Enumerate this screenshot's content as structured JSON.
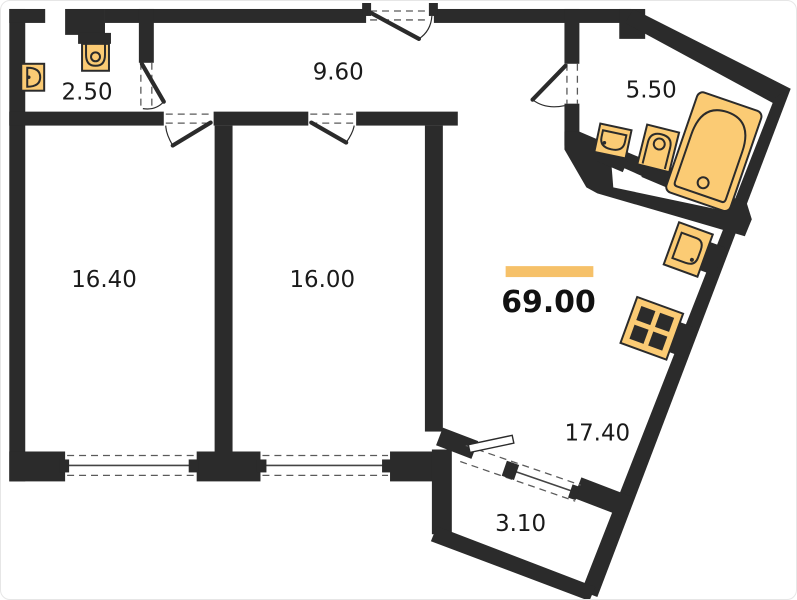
{
  "plan": {
    "total_area": {
      "value": "69.00"
    },
    "rooms": [
      {
        "id": "wc",
        "area": "2.50"
      },
      {
        "id": "hallway",
        "area": "9.60"
      },
      {
        "id": "bathroom",
        "area": "5.50"
      },
      {
        "id": "bedroom-1",
        "area": "16.40"
      },
      {
        "id": "bedroom-2",
        "area": "16.00"
      },
      {
        "id": "kitchen-living",
        "area": "17.40"
      },
      {
        "id": "balcony",
        "area": "3.10"
      }
    ],
    "fixtures": [
      "wc-toilet-icon",
      "wc-sink-icon",
      "bathroom-sink-icon",
      "bathroom-toilet-icon",
      "bathtub-icon",
      "kitchen-sink-icon",
      "stove-icon"
    ],
    "colors": {
      "wall": "#2b2b2b",
      "fixture_fill": "#fbcb74",
      "accent": "#f6c169",
      "label": "#1a1a1a"
    }
  }
}
